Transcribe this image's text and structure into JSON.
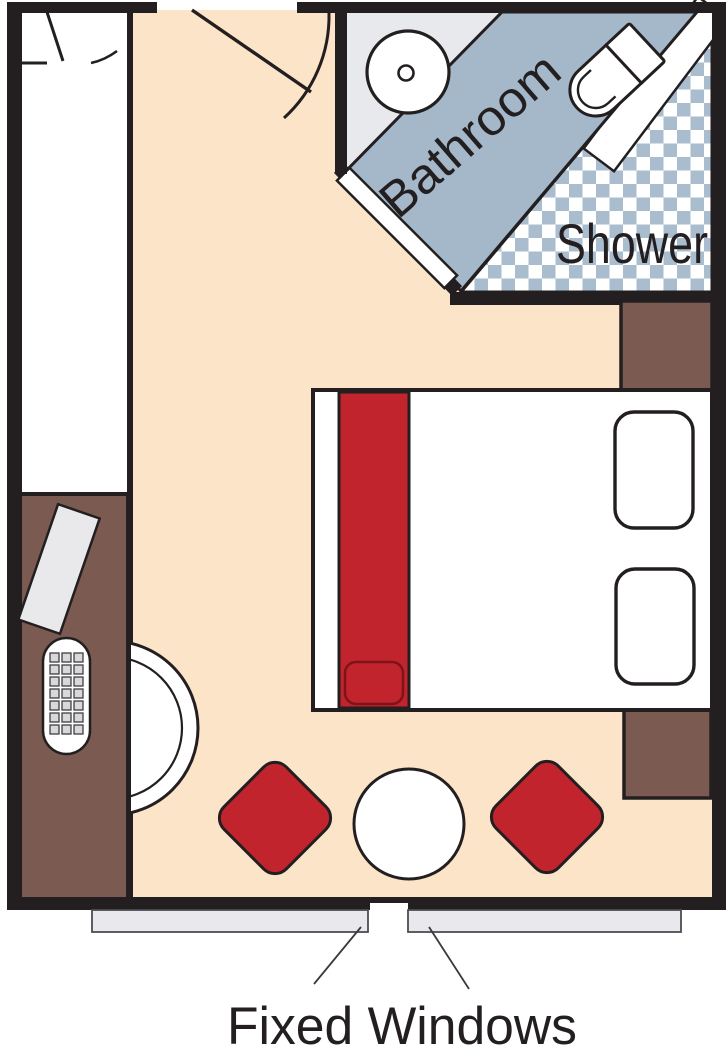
{
  "diagram": {
    "type": "stateroom-floor-plan",
    "labels": {
      "bathroom": "Bathroom",
      "shower": "Shower",
      "fixed_windows": "Fixed Windows"
    },
    "furniture": [
      "entrance-door",
      "closet",
      "desk",
      "desk-phone",
      "desk-clipboard",
      "half-round-chair",
      "double-bed",
      "bed-runner",
      "pillows",
      "wardrobe",
      "nightstand",
      "sink",
      "toilet",
      "shower-floor",
      "armchair-left",
      "armchair-right",
      "round-table",
      "fixed-windows"
    ],
    "colors": {
      "wall": "#231f20",
      "floor": "#fce4c9",
      "white": "#ffffff",
      "bathroom_floor": "#e8e9ed",
      "band_blue": "#a4b8c9",
      "checker_blue": "#a9bdcf",
      "furniture_brown": "#7b5a51",
      "accent_red": "#c2242e",
      "accent_red_dark": "#7e1318",
      "window_gray": "#e9e9ed",
      "item_gray": "#e9e9eb",
      "leader_line": "#3a3a3a",
      "text": "#231f20"
    }
  }
}
